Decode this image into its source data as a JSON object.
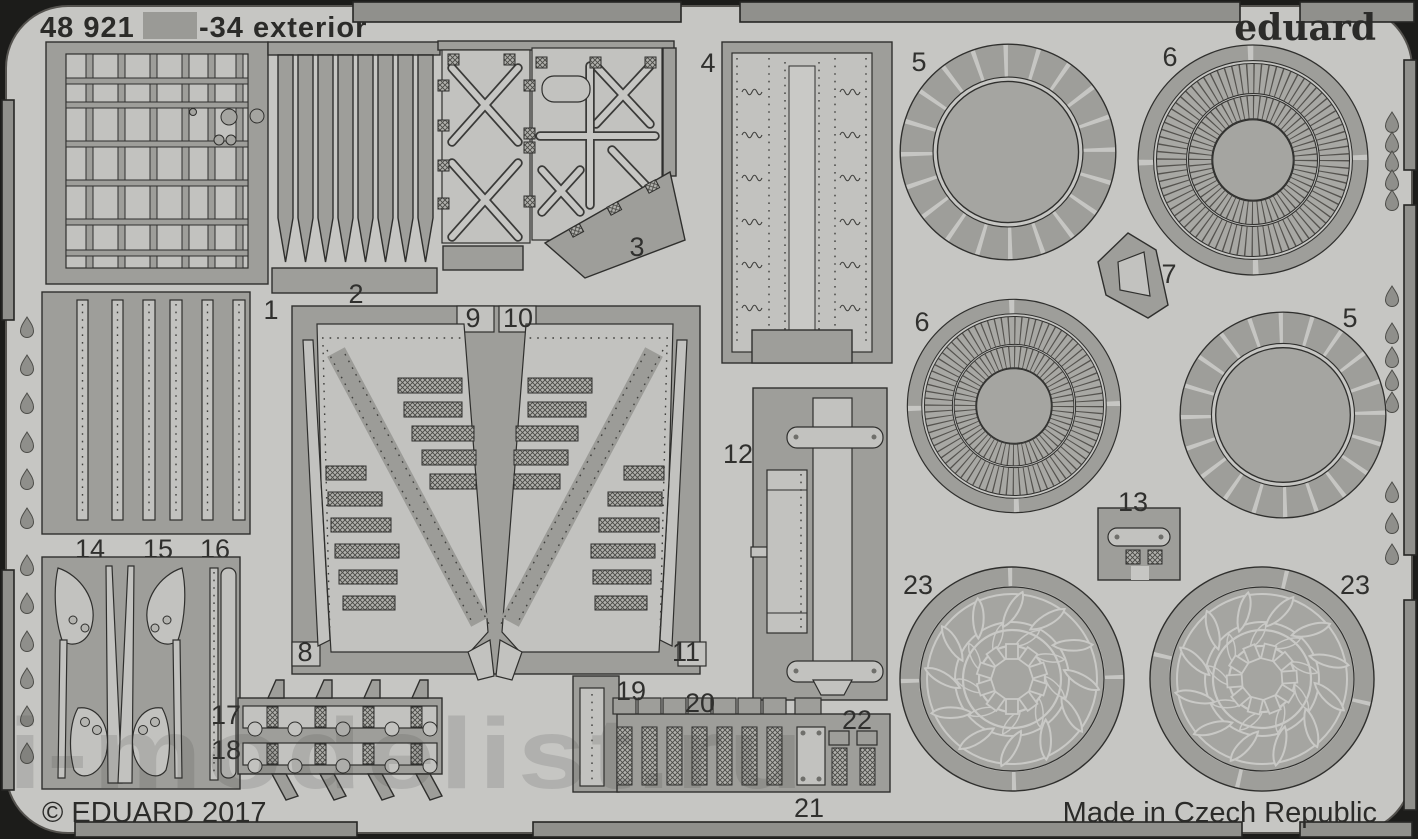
{
  "header": {
    "catalog_number": "48 921",
    "product_name": "-34 exterior",
    "brand_logo": "eduard",
    "censored_patch": "blurred grey rectangle hiding aircraft prefix"
  },
  "footer": {
    "copyright": "© EDUARD 2017",
    "origin": "Made in Czech Republic"
  },
  "watermark": {
    "text": "i-modelist.ru"
  },
  "part_labels": {
    "p1": "1",
    "p2": "2",
    "p3": "3",
    "p4": "4",
    "p5a": "5",
    "p5b": "5",
    "p6a": "6",
    "p6b": "6",
    "p7": "7",
    "p8": "8",
    "p9": "9",
    "p10": "10",
    "p11": "11",
    "p12": "12",
    "p13": "13",
    "p14": "14",
    "p15": "15",
    "p16": "16",
    "p17": "17",
    "p18": "18",
    "p19": "19",
    "p20": "20",
    "p21": "21",
    "p22": "22",
    "p23a": "23",
    "p23b": "23"
  },
  "colors": {
    "photo_background": "#1c1c1a",
    "sheet": "#c6c6c3",
    "fret_metal": "#9e9e9a",
    "etched_light": "#c2c2bf",
    "outline": "#2f2f2d",
    "ink": "#2b2b29"
  }
}
